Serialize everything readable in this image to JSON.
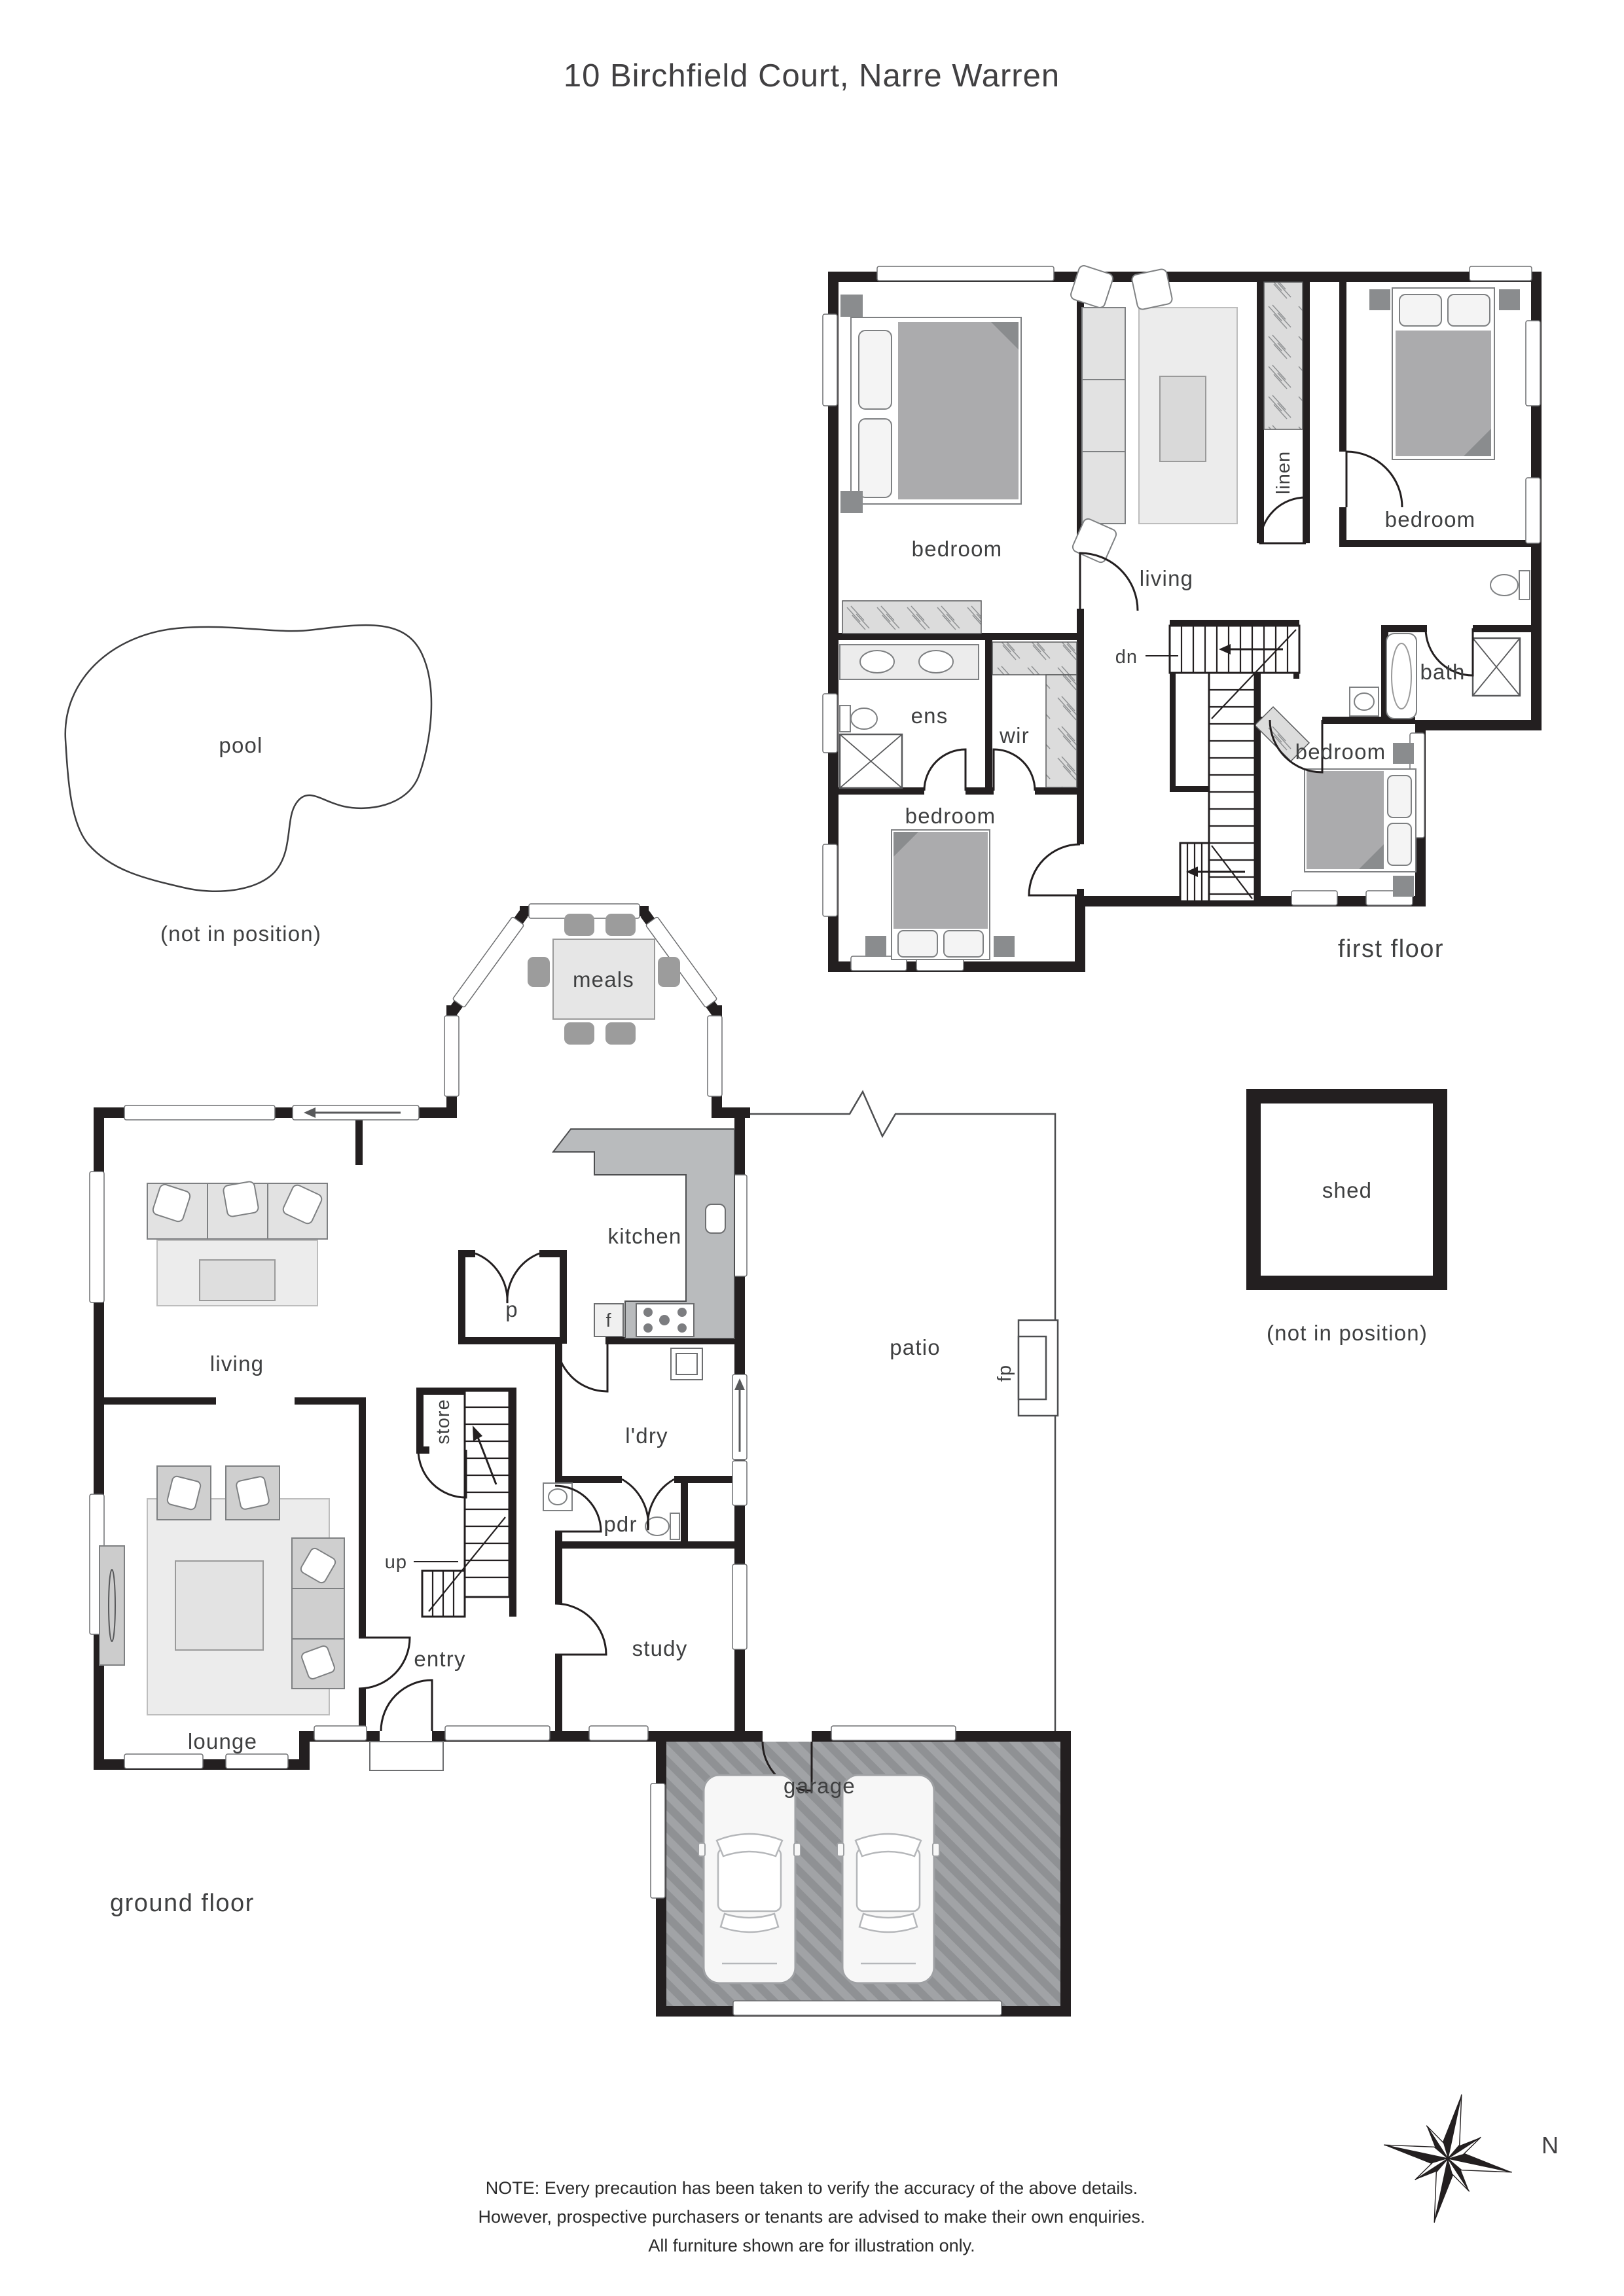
{
  "title": "10 Birchfield Court, Narre Warren",
  "floors": {
    "first": {
      "label": "first floor",
      "rooms": {
        "bedroom_tl": "bedroom",
        "living": "living",
        "linen": "linen",
        "bedroom_tr": "bedroom",
        "ens": "ens",
        "wir": "wir",
        "bath": "bath",
        "bedroom_bl": "bedroom",
        "bedroom_br": "bedroom"
      },
      "stairs": {
        "down": "dn"
      }
    },
    "ground": {
      "label": "ground floor",
      "rooms": {
        "meals": "meals",
        "kitchen": "kitchen",
        "pantry": "p",
        "fridge": "f",
        "living": "living",
        "store": "store",
        "laundry": "l'dry",
        "powder": "pdr",
        "entry": "entry",
        "study": "study",
        "patio": "patio",
        "fireplace": "fp",
        "lounge": "lounge",
        "garage": "garage"
      },
      "stairs": {
        "up": "up"
      }
    }
  },
  "outbuildings": {
    "pool": {
      "label": "pool",
      "note": "(not in position)"
    },
    "shed": {
      "label": "shed",
      "note": "(not in position)"
    }
  },
  "compass": {
    "north": "N"
  },
  "disclaimer": {
    "line1": "NOTE: Every precaution has been taken to verify the accuracy of the above details.",
    "line2": "However, prospective purchasers or tenants are advised to make their own enquiries.",
    "line3": "All furniture shown are for illustration only."
  },
  "colors": {
    "wall": "#231f20",
    "label": "#3f4041",
    "furniture_light": "#ececec",
    "furniture_mid": "#c9cacb",
    "blanket": "#ababad",
    "counter": "#b9bbbd",
    "garage_floor": "#9a9c9f"
  }
}
